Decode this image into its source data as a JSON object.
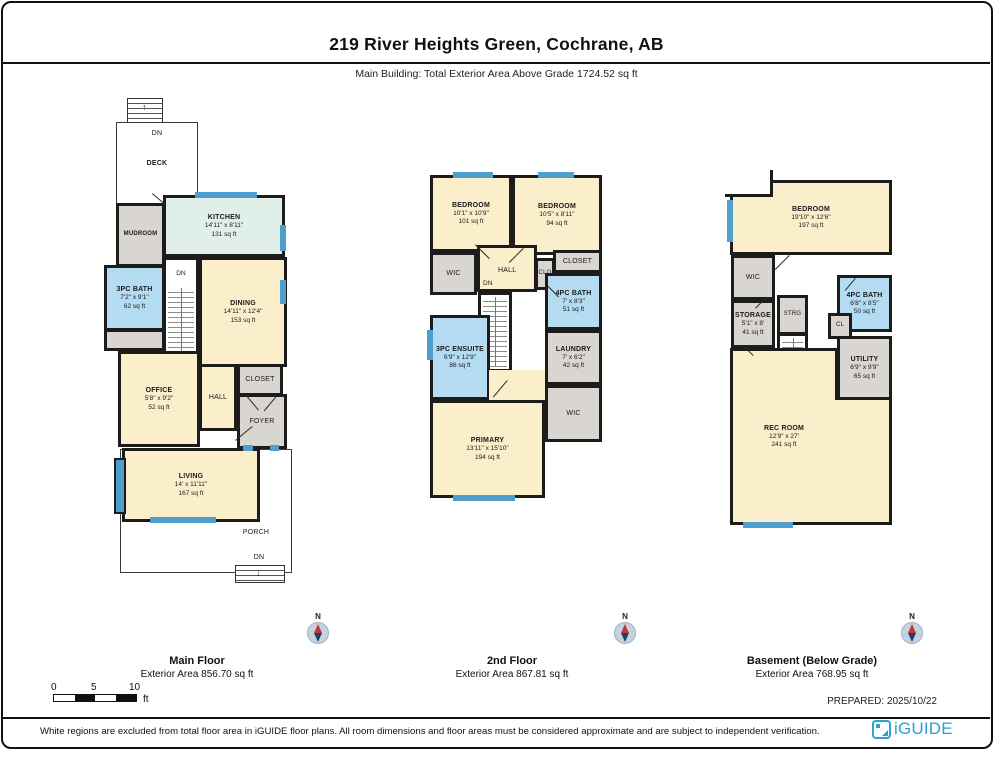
{
  "page": {
    "title": "219 River Heights Green, Cochrane, AB",
    "subtitle": "Main Building: Total Exterior Area Above Grade 1724.52 sq ft",
    "prepared": "PREPARED: 2025/10/22",
    "disclaimer": "White regions are excluded from total floor area in iGUIDE floor plans. All room dimensions and floor areas must be considered approximate and are subject to independent verification.",
    "brand": "iGUIDE"
  },
  "colors": {
    "brand_blue": "#2ba2cf",
    "window_blue": "#4f9ecd",
    "room_beige": "#faeecb",
    "room_bath_blue": "#b3dbf2",
    "room_gray": "#d9d5d0",
    "room_kitchen_teal": "#e1efe9",
    "wall_black": "#1c1c1c"
  },
  "compass_label": "N",
  "scale_bar": {
    "labels": [
      "0",
      "5",
      "10"
    ],
    "unit": "ft"
  },
  "floors": [
    {
      "name": "Main Floor",
      "area": "Exterior Area 856.70 sq ft"
    },
    {
      "name": "2nd Floor",
      "area": "Exterior Area 867.81 sq ft"
    },
    {
      "name": "Basement (Below Grade)",
      "area": "Exterior Area 768.95 sq ft"
    }
  ],
  "rooms": {
    "main": {
      "deck": {
        "name": "DECK"
      },
      "dn_deck": "DN",
      "mudroom": {
        "name": "MUDROOM"
      },
      "kitchen": {
        "name": "KITCHEN",
        "dims": "14'11\" x 8'11\"",
        "area": "131 sq ft"
      },
      "bath": {
        "name": "3PC BATH",
        "dims": "7'2\" x 9'1\"",
        "area": "62 sq ft"
      },
      "dining": {
        "name": "DINING",
        "dims": "14'11\" x 12'4\"",
        "area": "153 sq ft"
      },
      "dn_stairs": "DN",
      "up_stairs": "UP",
      "office": {
        "name": "OFFICE",
        "dims": "5'8\" x 9'2\"",
        "area": "52 sq ft"
      },
      "hall": {
        "name": "HALL"
      },
      "closet": {
        "name": "CLOSET"
      },
      "foyer": {
        "name": "FOYER"
      },
      "living": {
        "name": "LIVING",
        "dims": "14' x 11'11\"",
        "area": "167 sq ft"
      },
      "porch": {
        "name": "PORCH"
      },
      "dn_porch": "DN"
    },
    "second": {
      "bedroom1": {
        "name": "BEDROOM",
        "dims": "10'1\" x 10'9\"",
        "area": "101 sq ft"
      },
      "bedroom2": {
        "name": "BEDROOM",
        "dims": "10'5\" x 8'11\"",
        "area": "94 sq ft"
      },
      "wic": {
        "name": "WIC"
      },
      "hall": {
        "name": "HALL"
      },
      "clo": {
        "name": "CLO"
      },
      "closet": {
        "name": "CLOSET"
      },
      "bath": {
        "name": "4PC BATH",
        "dims": "7' x 8'3\"",
        "area": "51 sq ft"
      },
      "dn": "DN",
      "ensuite": {
        "name": "3PC ENSUITE",
        "dims": "6'9\" x 12'9\"",
        "area": "86 sq ft"
      },
      "laundry": {
        "name": "LAUNDRY",
        "dims": "7' x 6'2\"",
        "area": "42 sq ft"
      },
      "wic2": {
        "name": "WIC"
      },
      "primary": {
        "name": "PRIMARY",
        "dims": "13'11\" x 15'10\"",
        "area": "194 sq ft"
      }
    },
    "basement": {
      "bedroom": {
        "name": "BEDROOM",
        "dims": "19'10\" x 12'6\"",
        "area": "197 sq ft"
      },
      "wic": {
        "name": "WIC"
      },
      "strg": {
        "name": "STRG"
      },
      "storage": {
        "name": "STORAGE",
        "dims": "5'1\" x 8'",
        "area": "41 sq ft"
      },
      "cl": {
        "name": "CL"
      },
      "bath": {
        "name": "4PC BATH",
        "dims": "6'8\" x 8'5\"",
        "area": "50 sq ft"
      },
      "utility": {
        "name": "UTILITY",
        "dims": "6'9\" x 9'9\"",
        "area": "65 sq ft"
      },
      "recroom": {
        "name": "REC ROOM",
        "dims": "12'9\" x 27'",
        "area": "241 sq ft"
      },
      "up": "UP"
    }
  }
}
